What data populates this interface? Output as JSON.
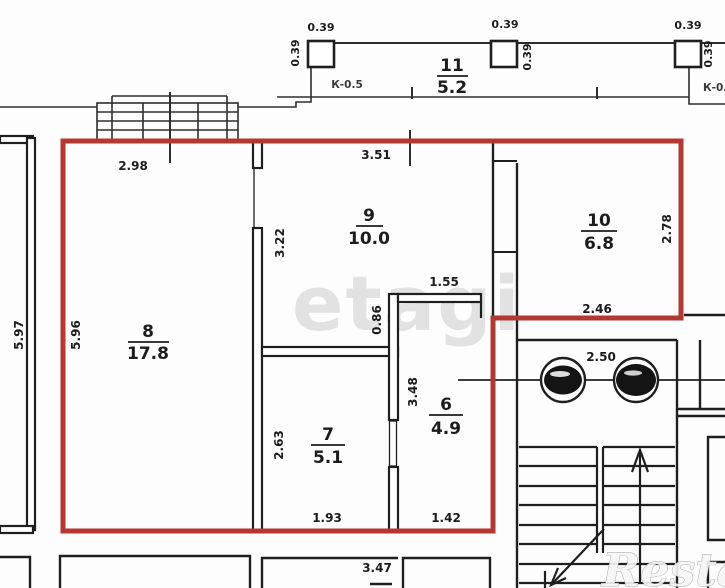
{
  "plan_title": "Apartment floor plan with highlighted unit",
  "colors": {
    "highlight_red": "#b43832",
    "wall_black": "#1f1f1f",
    "thin_line": "#2e2e2e",
    "watermark_gray": "#cdcdcd"
  },
  "rooms": [
    {
      "number": "8",
      "area": "17.8"
    },
    {
      "number": "9",
      "area": "10.0"
    },
    {
      "number": "10",
      "area": "6.8"
    },
    {
      "number": "7",
      "area": "5.1"
    },
    {
      "number": "6",
      "area": "4.9"
    },
    {
      "number": "11",
      "area": "5.2"
    }
  ],
  "dimensions": {
    "room8_top": "2.98",
    "room9_top": "3.51",
    "pillar1_top": "0.39",
    "pillar2_top": "0.39",
    "pillar3_top": "0.39",
    "pillar1_side": "0.39",
    "pillar2_side": "0.39",
    "pillar3_side": "0.39",
    "left_outer": "5.97",
    "left_inner": "5.96",
    "room9_left": "3.22",
    "niche_height": "0.86",
    "niche_width": "1.55",
    "room10_right": "2.78",
    "room10_bottom": "2.46",
    "room7_left": "2.63",
    "room7_bottom": "1.93",
    "room6_left": "3.48",
    "room6_bottom": "1.42",
    "landing_width": "2.50",
    "bottom_section": "3.47"
  },
  "annotations": {
    "k_left": "К-0.5",
    "k_right": "К-0.5"
  },
  "watermarks": {
    "center": "etagi",
    "corner": "Restate"
  }
}
